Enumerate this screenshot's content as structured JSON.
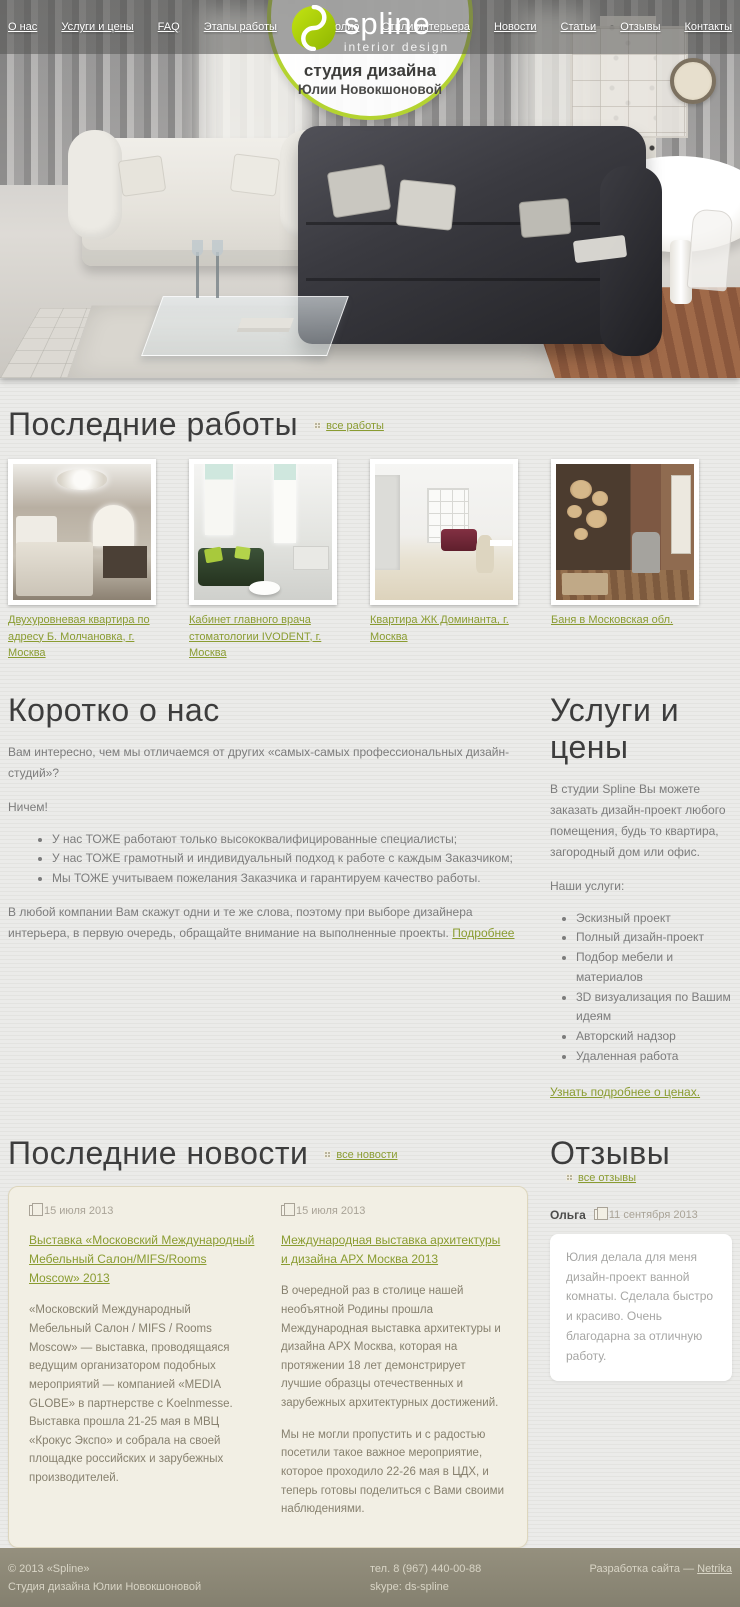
{
  "colors": {
    "accent_green": "#8a9c31",
    "logo_green": "#a6cb0c",
    "badge_ring": "#b4d331",
    "card_bg": "#f2efe4",
    "footer_bg": "#8b8678"
  },
  "nav": {
    "left": [
      "О нас",
      "Услуги и цены",
      "FAQ",
      "Этапы работы",
      "Портфолио"
    ],
    "right": [
      "Стили интерьера",
      "Новости",
      "Статьи",
      "Отзывы",
      "Контакты"
    ]
  },
  "logo": {
    "name": "spline",
    "tagline": "interior design"
  },
  "badge": {
    "line1": "студия дизайна",
    "line2": "Юлии Новокшоновой"
  },
  "works": {
    "title": "Последние работы",
    "all_link": "все работы",
    "items": [
      {
        "caption": "Двухуровневая квартира по адресу Б. Молчановка, г. Москва"
      },
      {
        "caption": "Кабинет главного врача стоматологии IVODENT, г. Москва"
      },
      {
        "caption": "Квартира ЖК Доминанта, г. Москва"
      },
      {
        "caption": "Баня в Московская обл."
      }
    ]
  },
  "about": {
    "title": "Коротко о нас",
    "intro": "Вам интересно, чем мы отличаемся от других «самых-самых профессиональных дизайн-студий»?",
    "exclaim": "Ничем!",
    "bullets": [
      "У нас ТОЖЕ работают только высококвалифицированные специалисты;",
      "У нас ТОЖЕ грамотный и индивидуальный подход к работе с каждым Заказчиком;",
      "Мы ТОЖЕ учитываем пожелания Заказчика и гарантируем качество работы."
    ],
    "outro": "В любой компании Вам скажут одни и те же слова, поэтому при выборе дизайнера интерьера, в первую очередь, обращайте внимание на выполненные проекты.",
    "more_link": "Подробнее"
  },
  "services": {
    "title": "Услуги и цены",
    "intro": "В студии Spline Вы можете заказать дизайн-проект любого помещения, будь то квартира, загородный дом или офис.",
    "list_label": "Наши услуги:",
    "items": [
      "Эскизный проект",
      "Полный дизайн-проект",
      "Подбор мебели и материалов",
      "3D визуализация по Вашим идеям",
      "Авторский надзор",
      "Удаленная работа"
    ],
    "prices_link": "Узнать подробнее о ценах."
  },
  "news": {
    "title": "Последние новости",
    "all_link": "все новости",
    "items": [
      {
        "date": "15 июля 2013",
        "title": "Выставка «Московский Международный Мебельный Салон/MIFS/Rooms Moscow» 2013",
        "paragraphs": [
          "«Московский Международный Мебельный Салон / MIFS / Rooms Moscow» — выставка, проводящаяся ведущим организатором подобных мероприятий — компанией «MEDIA GLOBE» в партнерстве с Koelnmesse. Выставка прошла 21-25 мая в МВЦ «Крокус Экспо» и собрала на своей площадке российских и зарубежных производителей."
        ]
      },
      {
        "date": "15 июля 2013",
        "title": "Международная выставка архитектуры и дизайна АРХ Москва 2013",
        "paragraphs": [
          "В очередной раз в столице нашей необъятной Родины прошла Международная выставка архитектуры и дизайна АРХ Москва, которая на протяжении 18 лет демонстрирует лучшие образцы отечественных и зарубежных архитектурных достижений.",
          "Мы не могли пропустить и с радостью посетили такое важное мероприятие, которое проходило 22-26 мая в ЦДХ, и теперь готовы поделиться с Вами своими наблюдениями."
        ]
      }
    ]
  },
  "reviews": {
    "title": "Отзывы",
    "all_link": "все отзывы",
    "author": "Ольга",
    "date": "11 сентября 2013",
    "text": "Юлия делала для меня дизайн-проект ванной комнаты. Сделала быстро и красиво. Очень благодарна за отличную работу."
  },
  "footer": {
    "copyright": "© 2013 «Spline»",
    "studio": "Студия дизайна Юлии Новокшоновой",
    "phone": "тел. 8 (967) 440-00-88",
    "skype": "skype: ds-spline",
    "dev_label": "Разработка сайта — ",
    "dev_link": "Netrika"
  }
}
